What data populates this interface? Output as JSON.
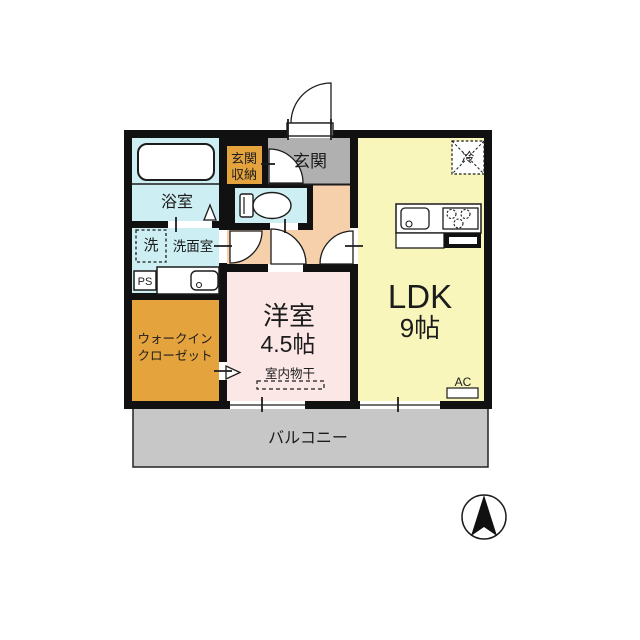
{
  "labels": {
    "bathroom": "浴室",
    "washer": "洗",
    "washroom": "洗面室",
    "ps": "PS",
    "wic1": "ウォークイン",
    "wic2": "クローゼット",
    "storage1": "玄関",
    "storage2": "収納",
    "entrance": "玄関",
    "fridge": "冷",
    "ldk": "LDK",
    "ldk_size": "9帖",
    "western": "洋室",
    "western_size": "4.5帖",
    "drying": "室内物干",
    "ac": "AC",
    "balcony": "バルコニー"
  },
  "colors": {
    "wall": "#111111",
    "wet": "#cdeef2",
    "closet": "#e5a33d",
    "entrance_floor": "#b0b0b0",
    "hall": "#f5d0ab",
    "western": "#fbe7e6",
    "ldk": "#f8f6bb",
    "balcony": "#c7c7c7",
    "line": "#1c1c1c"
  }
}
